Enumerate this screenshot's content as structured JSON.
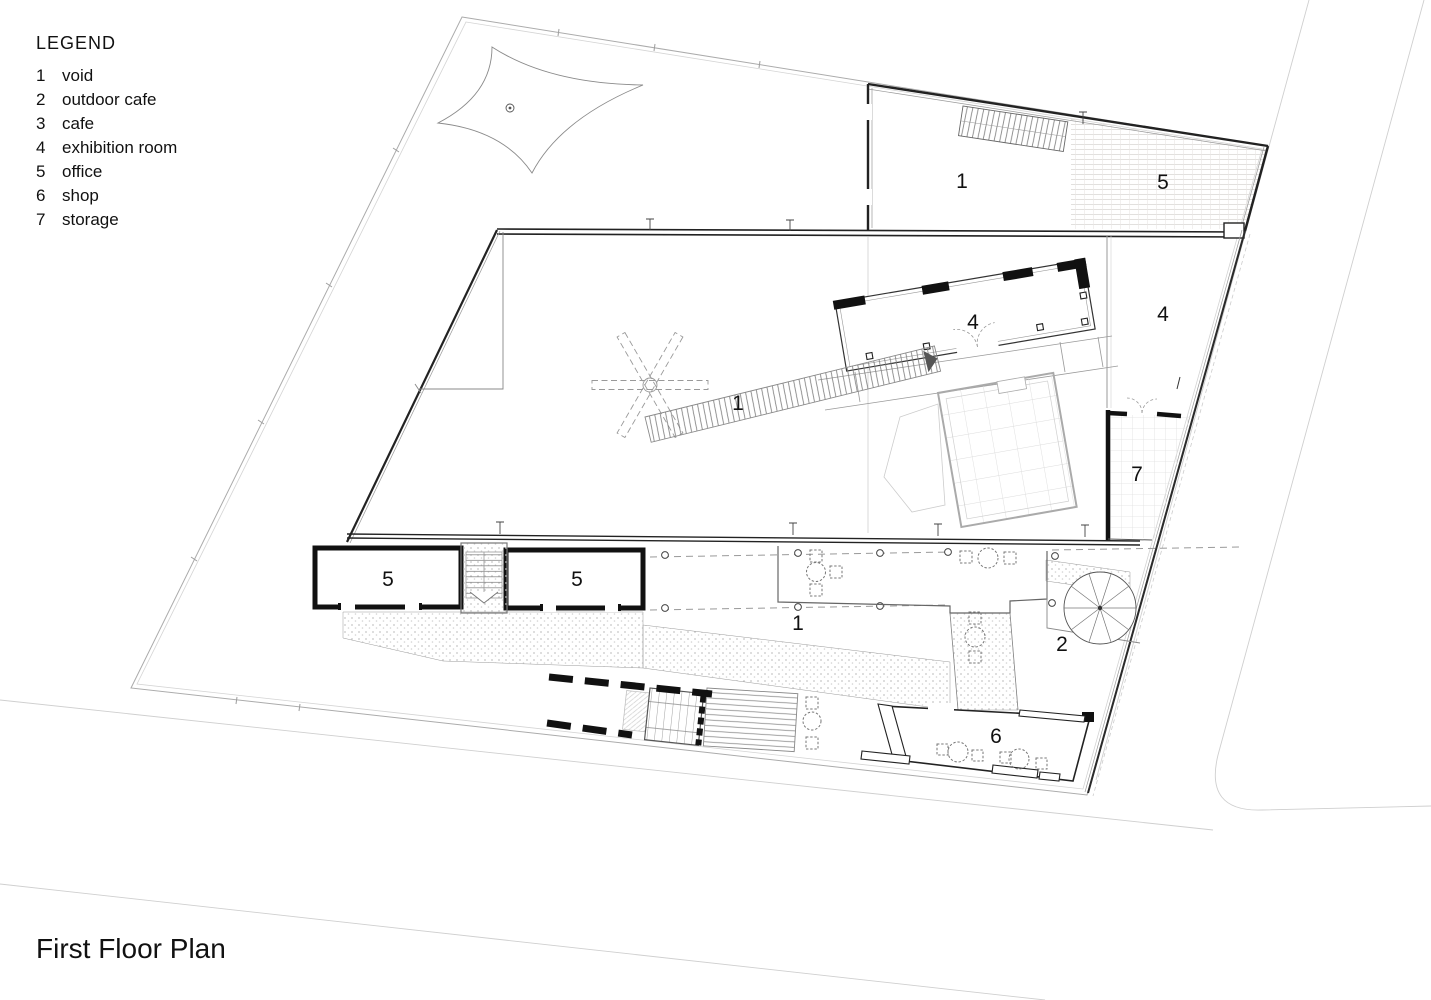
{
  "title": "First Floor Plan",
  "legend": {
    "heading": "LEGEND",
    "items": [
      {
        "num": "1",
        "label": "void"
      },
      {
        "num": "2",
        "label": "outdoor cafe"
      },
      {
        "num": "3",
        "label": "cafe"
      },
      {
        "num": "4",
        "label": "exhibition room"
      },
      {
        "num": "5",
        "label": "office"
      },
      {
        "num": "6",
        "label": "shop"
      },
      {
        "num": "7",
        "label": "storage"
      }
    ]
  },
  "room_labels": [
    {
      "num": "1",
      "room": "void"
    },
    {
      "num": "5",
      "room": "office"
    },
    {
      "num": "4",
      "room": "exhibition room"
    },
    {
      "num": "4",
      "room": "exhibition room"
    },
    {
      "num": "1",
      "room": "void"
    },
    {
      "num": "7",
      "room": "storage"
    },
    {
      "num": "5",
      "room": "office"
    },
    {
      "num": "5",
      "room": "office"
    },
    {
      "num": "1",
      "room": "void"
    },
    {
      "num": "2",
      "room": "outdoor cafe"
    },
    {
      "num": "6",
      "room": "shop"
    }
  ],
  "colors": {
    "paper": "#ffffff",
    "ink": "#111111",
    "wall_dark": "#222222",
    "line_medium": "#888888",
    "line_light": "#c9c9c9"
  }
}
